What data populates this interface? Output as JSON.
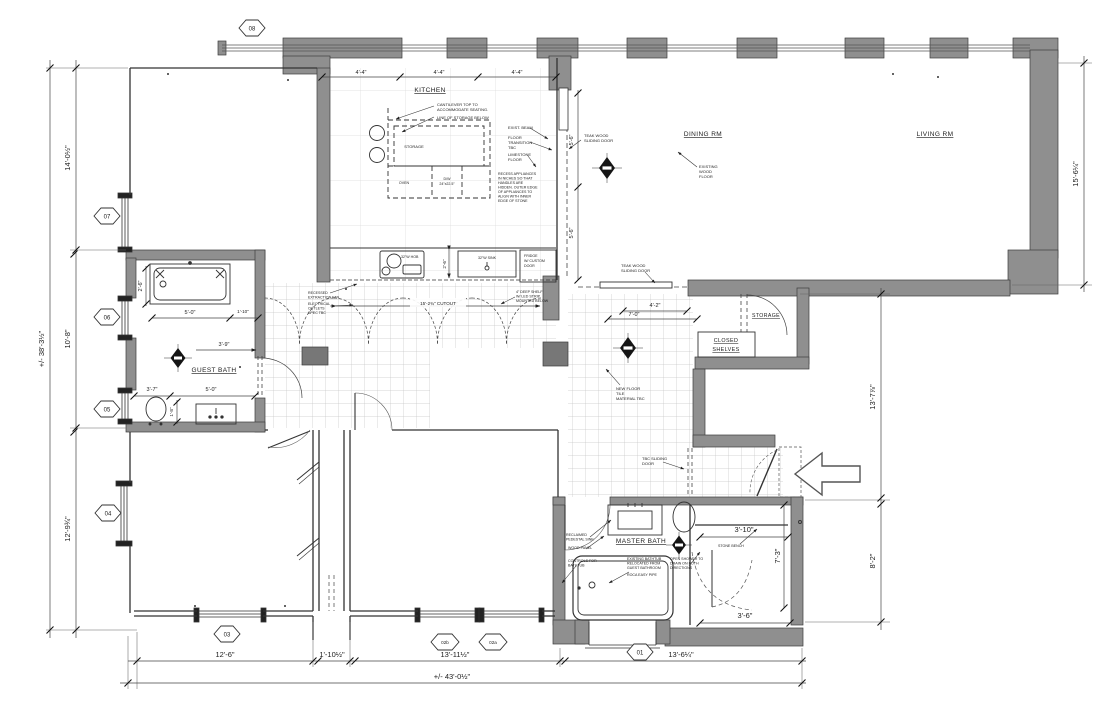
{
  "rooms": {
    "kitchen": "KITCHEN",
    "dining": "DINING RM",
    "living": "LIVING RM",
    "guest_bath": "GUEST BATH",
    "master_bath": "MASTER BATH",
    "storage": "STORAGE",
    "closed_shelves": [
      "CLOSED",
      "SHELVES"
    ]
  },
  "markers": {
    "m08": "08",
    "m07": "07",
    "m06": "06",
    "m05": "05",
    "m04": "04",
    "m03": "03",
    "m02b": "02b",
    "m02a": "02a",
    "m01": "01"
  },
  "dimensions": {
    "overall_width": "+/- 43'-0½\"",
    "overall_height": "+/- 38'-3½\"",
    "left_top": "14'-0½\"",
    "left_mid": "10'-8\"",
    "left_bottom": "12'-9¾\"",
    "right_living": "15'-6¼\"",
    "right_hall": "13'-7⅞\"",
    "right_lower": "8'-2\"",
    "bottom_left": "12'-6\"",
    "bottom_shaft": "1'-10½\"",
    "bottom_mid": "13'-11½\"",
    "bottom_right": "13'-6¼\"",
    "kitchen_top_1": "4'-4\"",
    "kitchen_top_2": "4'-4\"",
    "kitchen_top_3": "4'-4\"",
    "kitchen_counter_depth": "2'-6\"",
    "kitchen_cutout": "15'-2¾\" CUTOUT",
    "slider_upper": "5'-6\"",
    "slider_lower": "5'-6\"",
    "hall_a": "4'-2\"",
    "hall_b": "7'-0\"",
    "gb_tub_w": "2'-6\"",
    "gb_tub_l": "5'-0\"",
    "gb_niche": "1'-10\"",
    "gb_mid": "3'-9\"",
    "gb_toilet": "3'-7\"",
    "gb_vanity": "5'-0\"",
    "gb_depth": "1'-8\"",
    "mb_shower_w": "3'-10\"",
    "mb_shower_h": "7'-3\"",
    "mb_door": "3'-6\""
  },
  "fixtures": {
    "hob": "32\"W HOB",
    "sink": "32\"W SINK",
    "fridge": [
      "FRIDGE",
      "W/ CUSTOM",
      "DOOR"
    ],
    "oven": "OVEN",
    "dw": [
      "D/W",
      "24\"x22.5\""
    ],
    "storage_island": "STORAGE"
  },
  "annotations": {
    "cantilever": [
      "CANTILEVER TOP TO",
      "ACCOMMODATE SEATING."
    ],
    "line_storage": "LINE OF STORAGE BELOW",
    "exist_beam": "EXIST. BEAM",
    "floor_transition": [
      "FLOOR",
      "TRANSITION",
      "TBC"
    ],
    "limestone": [
      "LIMESTONE",
      "FLOOR"
    ],
    "recess": [
      "RECESS APPLIANCES",
      "IN NICHES SO THAT",
      "HANDLES ARE",
      "HIDDEN. OUTER EDGE",
      "OF APPLIANCES TO",
      "ALIGN WITH INNER",
      "EDGE OF STONE"
    ],
    "teak_door": [
      "TEAK WOOD",
      "SLIDING DOOR"
    ],
    "existing_wood": [
      "EXISTING",
      "WOOD",
      "FLOOR"
    ],
    "extraction": [
      "RECESSED",
      "EXTRACTION FAN"
    ],
    "outlets": [
      "ELECTRICAL",
      "OUTLETS",
      "SPEC TBC"
    ],
    "shelf": [
      "4\" DEEP SHELF",
      "W/ LED STRIP",
      "MOUNTED BELOW"
    ],
    "floor_tile": [
      "NEW FLOOR",
      "TILE",
      "MATERIAL TBC"
    ],
    "tbc_sliding": [
      "TBC SLIDING",
      "DOOR"
    ],
    "reclaimed": [
      "RECLAIMED",
      "PEDESTAL SINK"
    ],
    "wood_panel": "WOOD PANEL",
    "controls": [
      "CONTROLS FOR",
      "BATHTUB"
    ],
    "existing_tub": [
      "EXISTING BATHTUB",
      "RELOCATED FROM",
      "GUEST BATHROOM"
    ],
    "pipe": "ROCA EASY PIPE",
    "open_shower": [
      "OPEN SHOWER TO",
      "DRAIN ON BOTH",
      "DIRECTIONS"
    ],
    "stone_bench": "STONE BENCH"
  }
}
